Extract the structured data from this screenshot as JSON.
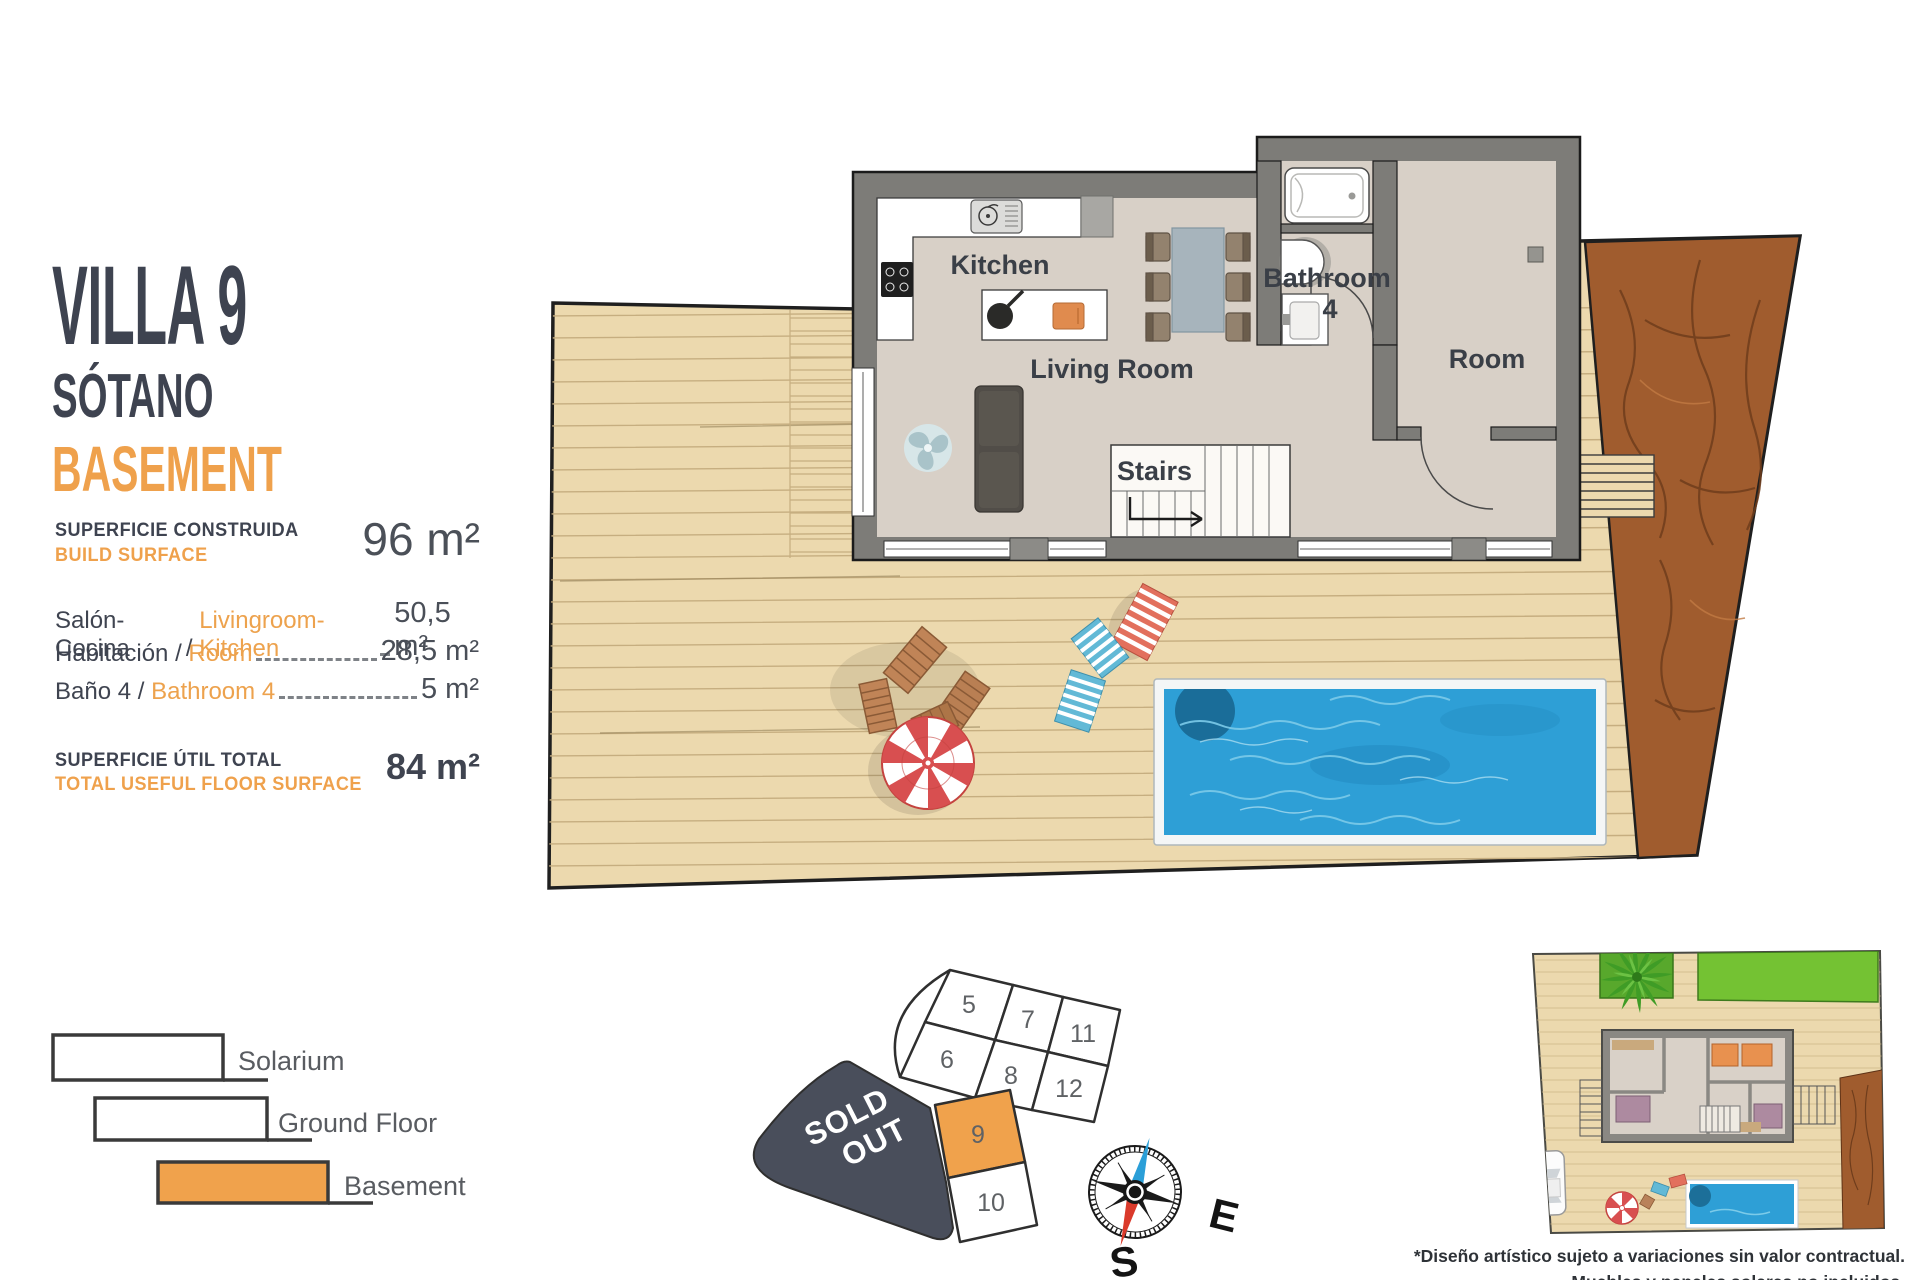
{
  "panel": {
    "title": "VILLA 9",
    "subtitle_es": "SÓTANO",
    "subtitle_en": "BASEMENT",
    "separator": " / ",
    "build_surface": {
      "label_es": "SUPERFICIE CONSTRUIDA",
      "label_en": "BUILD SURFACE",
      "value": "96 m²"
    },
    "rooms": [
      {
        "label_es": "Salón-Cocina",
        "label_en": "Livingroom-Kitchen",
        "value": "50,5 m²"
      },
      {
        "label_es": "Habitación",
        "label_en": "Room",
        "value": "28,5 m²"
      },
      {
        "label_es": "Baño 4",
        "label_en": "Bathroom 4",
        "value": "5 m²"
      }
    ],
    "total": {
      "label_es": "SUPERFICIE ÚTIL TOTAL",
      "label_en": "TOTAL USEFUL FLOOR SURFACE",
      "value": "84 m²"
    }
  },
  "floorplan": {
    "labels": {
      "kitchen": "Kitchen",
      "living_room": "Living Room",
      "bathroom": "Bathroom",
      "bathroom_number": "4",
      "room": "Room",
      "stairs": "Stairs"
    }
  },
  "legend": {
    "items": [
      {
        "label": "Solarium",
        "fill": "#FFFFFF"
      },
      {
        "label": "Ground Floor",
        "fill": "#FFFFFF"
      },
      {
        "label": "Basement",
        "fill": "#F0A24C"
      }
    ]
  },
  "plot_map": {
    "cells": [
      "5",
      "7",
      "11",
      "6",
      "8",
      "12",
      "9",
      "10"
    ],
    "highlighted_cell": "9",
    "sold_out_line1": "SOLD",
    "sold_out_line2": "OUT"
  },
  "compass": {
    "east": "E",
    "south": "S"
  },
  "disclaimer": {
    "line1": "*Diseño artístico sujeto a variaciones sin valor contractual.",
    "line2": "Muebles y paneles solares no incluidos."
  },
  "colors": {
    "accent_orange": "#F0A24C",
    "title_dark": "#3E4350",
    "deck_tan": "#ECD9AE",
    "dirt_brown": "#A05C2E",
    "pool_blue": "#2E9FD6",
    "wall_gray": "#7D7C78",
    "sold_out_dark": "#494E5B"
  }
}
